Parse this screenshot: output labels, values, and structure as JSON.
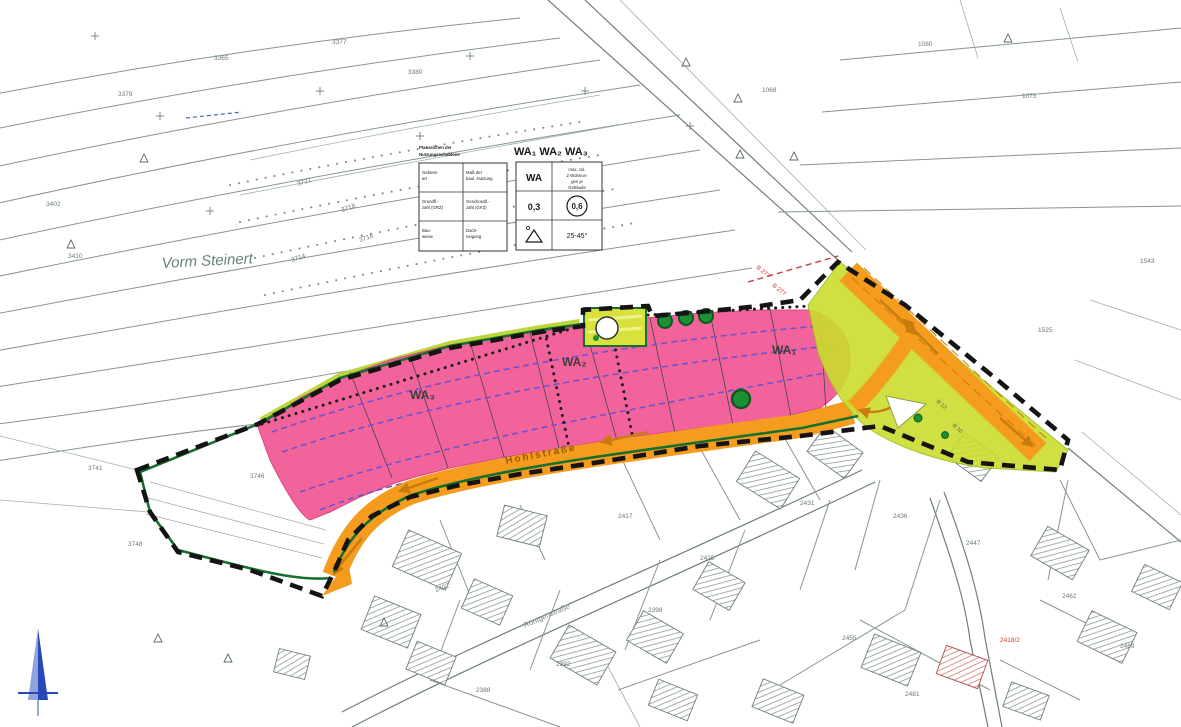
{
  "map_labels": {
    "area_name": "Vorm Steinert",
    "street_main": "Hohlstraße",
    "street_south": "Röntgenstraße",
    "road_ref": "B 277",
    "wa1": "WA₁",
    "wa2": "WA₂",
    "wa3": "WA₃"
  },
  "legend_key": {
    "title1": "Planzeichen der",
    "title2": "Nutzungsschablone",
    "cells": [
      [
        "Gebiets-",
        "art"
      ],
      [
        "Maß der",
        "baul. Nutzung"
      ],
      [
        "Grundfl.-",
        "zahl (GRZ)"
      ],
      [
        "Geschossfl.-",
        "zahl (GFZ)"
      ],
      [
        "Bau-",
        "weise"
      ],
      [
        "Dach-",
        "neigung"
      ]
    ]
  },
  "schablone": {
    "header": "WA₁  WA₂  WA₃",
    "area": "WA",
    "notes": [
      "max. zul.",
      "2 Wohnun-",
      "gen je",
      "Gebäude"
    ],
    "grz": "0,3",
    "gfz": "0,6",
    "pitch": "25-45°"
  },
  "junction_labels": [
    "R 12",
    "R 10"
  ],
  "parcels": [
    "3410",
    "3402",
    "3379",
    "3365",
    "3377",
    "3380",
    "3721",
    "3718",
    "3716",
    "3714",
    "1068",
    "1080",
    "1075",
    "1543",
    "1525",
    "3741",
    "3746",
    "3748",
    "2402",
    "2417",
    "2415",
    "2431",
    "2436",
    "2447",
    "2455",
    "2418/2",
    "2462",
    "2469",
    "2481",
    "2392",
    "2398",
    "2388"
  ],
  "colors": {
    "residential_pink": "#f2639b",
    "road_orange": "#f59b1e",
    "buffer_yellow_green": "#cbdc2e",
    "green_border": "#15702d",
    "building_envelope_purple": "#6f52cc",
    "plan_boundary_black": "#141414",
    "cadastral_line": "#87968f",
    "accent_red": "#cf3a3a",
    "north_arrow_blue": "#2749b8"
  }
}
